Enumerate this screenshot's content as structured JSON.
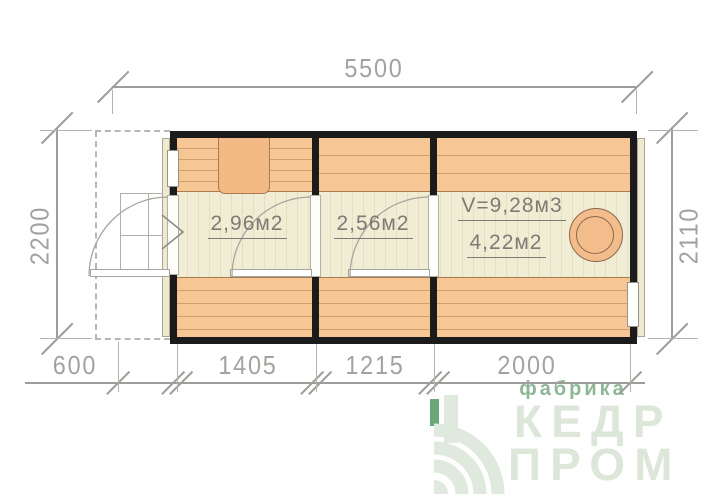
{
  "dimensions": {
    "top": "5500",
    "left": "2200",
    "right": "2110",
    "bottom": [
      "600",
      "1405",
      "1215",
      "2000"
    ]
  },
  "rooms": [
    {
      "area_label": "2,96м2"
    },
    {
      "area_label": "2,56м2"
    },
    {
      "volume_label": "V=9,28м3",
      "area_label": "4,22м2"
    }
  ],
  "logo": {
    "tagline": "фабрика",
    "name_line1": "КЕДР",
    "name_line2": "ПРОМ"
  },
  "icons": {
    "stove": "stove-icon",
    "door_swing": "door-swing-arc",
    "entry_arrow": "entry-direction-arrow",
    "logo_mark": "tree-rings-logo-icon"
  },
  "colors": {
    "wall_black": "#1b1b1b",
    "bench_orange": "#f6c694",
    "floor_cream": "#f1edd5",
    "stove_orange": "#f3bd8b",
    "dimension_gray": "#9d9d99",
    "label_gray": "#7c7c74",
    "logo_green": "#8db795",
    "logo_light": "#dce6d9"
  }
}
